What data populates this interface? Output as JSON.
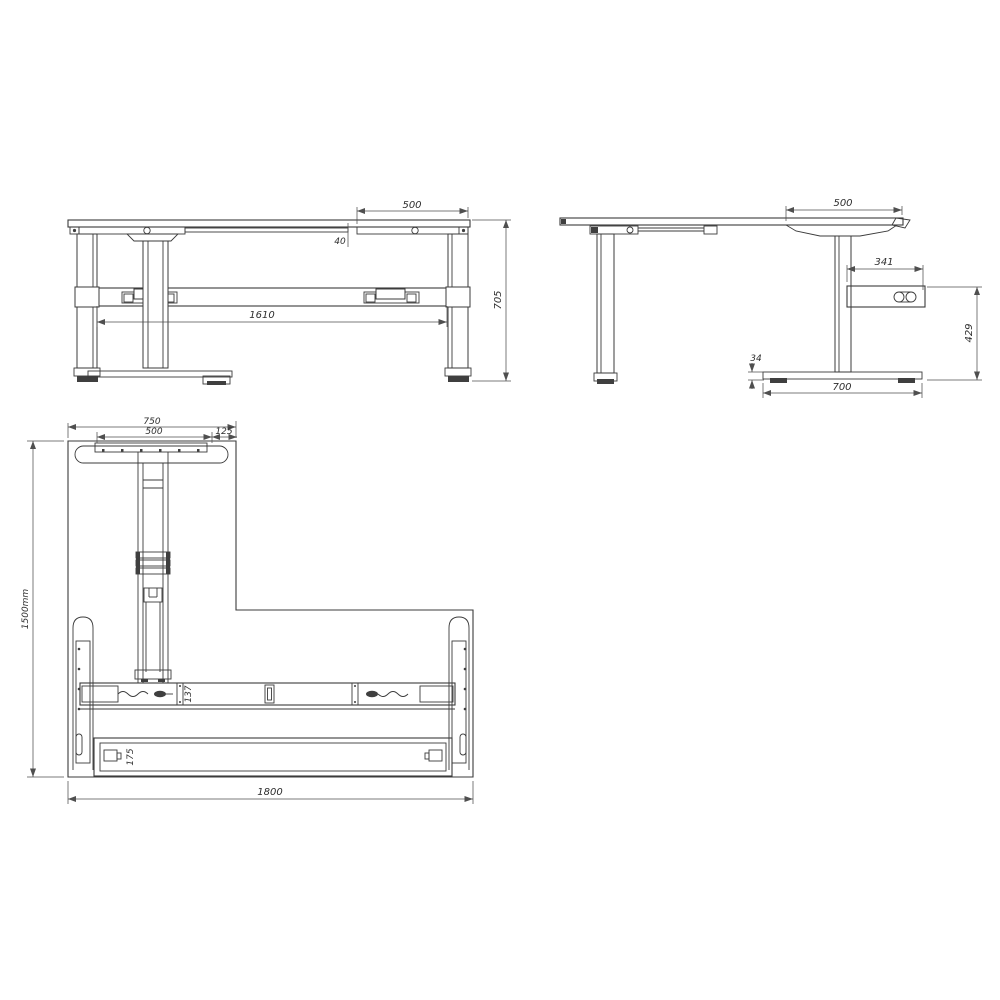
{
  "page": {
    "background": "#ffffff",
    "line_color": "#3b3b3b",
    "dimension_color": "#4f4f4f"
  },
  "views": {
    "front_view": {
      "dimensions": {
        "desktop_right_overhang": "500",
        "rail_gap": "40",
        "frame_width": "1610",
        "overall_height": "705"
      }
    },
    "side_view": {
      "dimensions": {
        "desktop_overhang": "500",
        "control_box_width": "341",
        "underside_height": "429",
        "foot_thickness": "34",
        "foot_depth": "700"
      }
    },
    "plan_view": {
      "dimensions": {
        "return_depth": "750",
        "return_plate_width": "500",
        "return_side_offset": "125",
        "overall_depth": "1500mm",
        "crossbar_depth": "137",
        "beam_depth": "175",
        "overall_width": "1800"
      }
    }
  }
}
